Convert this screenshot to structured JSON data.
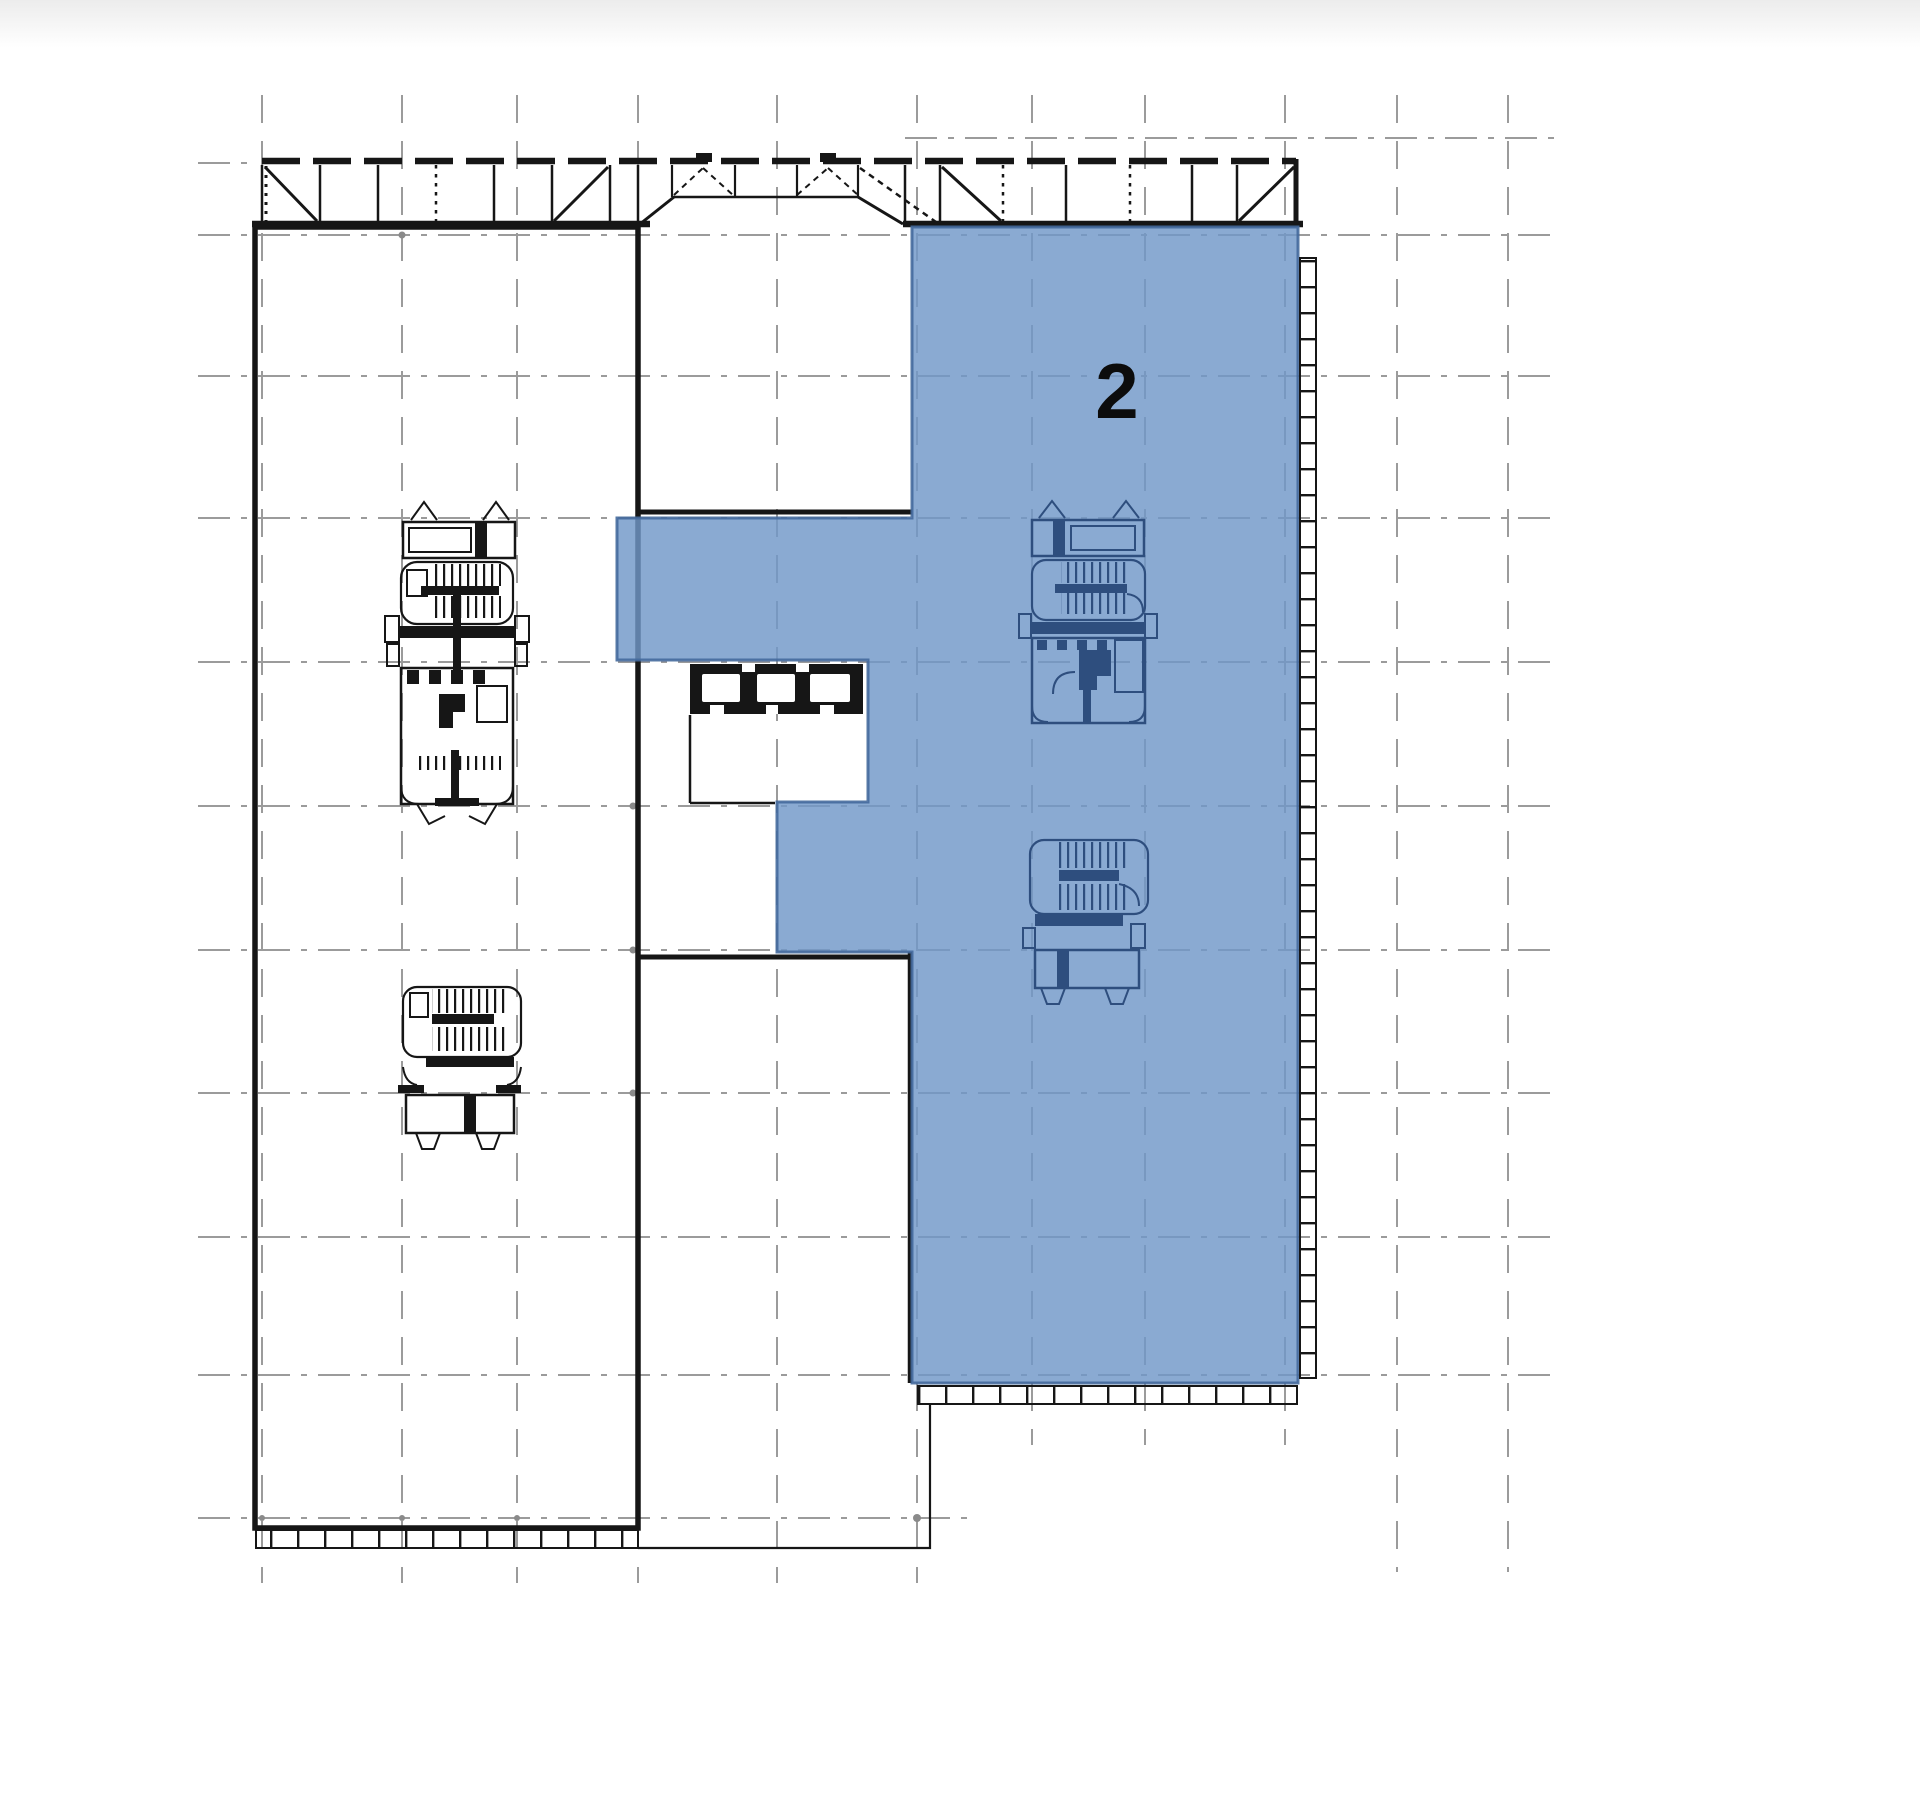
{
  "plan": {
    "zone": {
      "label": "2",
      "fill": "#7097c8",
      "border": "#44699c",
      "label_color": "#0c0c0c"
    },
    "colors": {
      "background": "#ffffff",
      "top_fade": "#ececec",
      "grid": "#9b9b9b",
      "outline": "#161616",
      "core_right": "#2e4e7e"
    }
  }
}
